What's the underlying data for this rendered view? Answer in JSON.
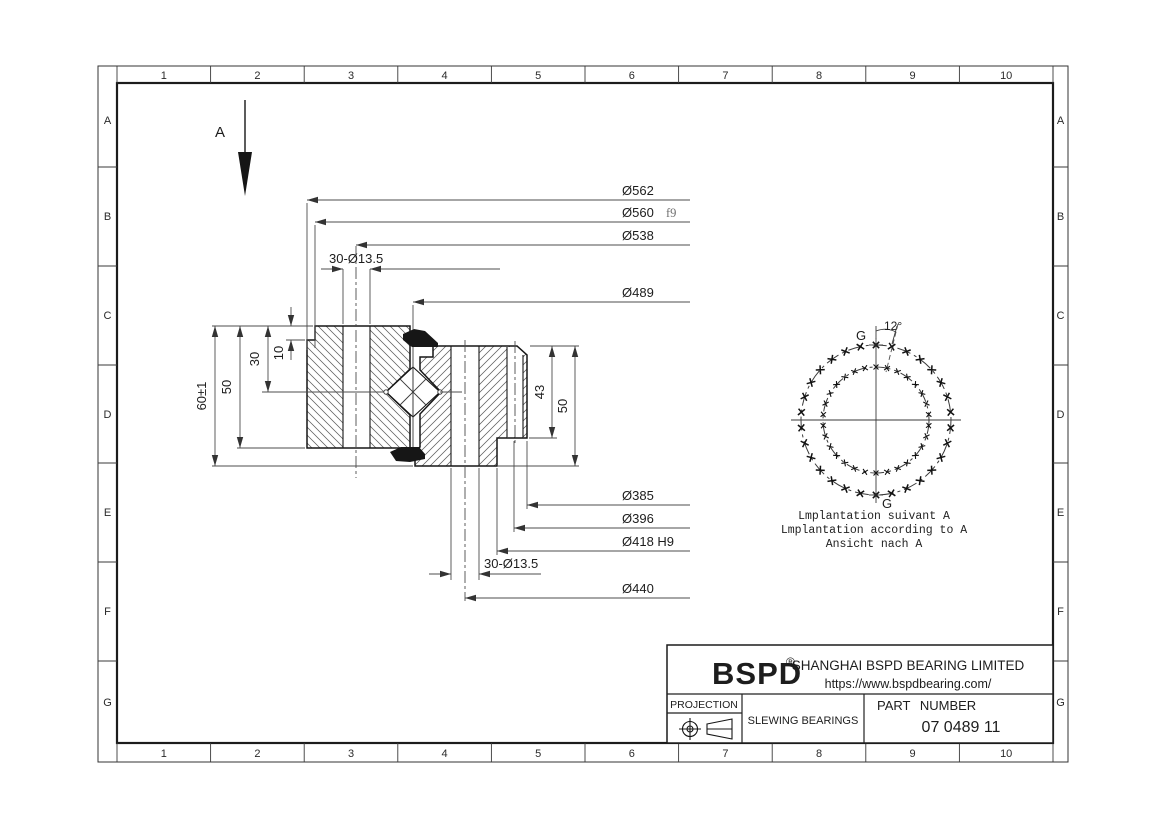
{
  "drawing": {
    "view_label": "A",
    "grid": {
      "columns": [
        "1",
        "2",
        "3",
        "4",
        "5",
        "6",
        "7",
        "8",
        "9",
        "10"
      ],
      "rows": [
        "A",
        "B",
        "C",
        "D",
        "E",
        "F",
        "G"
      ]
    },
    "dimensions": {
      "od_flange": "Ø562",
      "od_spigot": "Ø560",
      "od_spigot_fit": "f9",
      "outer_bolt_circle": "Ø538",
      "raceway": "Ø489",
      "outer_bolt_holes": "30-Ø13.5",
      "bore": "Ø385",
      "bore_step": "Ø396",
      "bore_recess": "Ø418 H9",
      "inner_bolt_circle": "Ø440",
      "inner_bolt_holes": "30-Ø13.5",
      "height_total": "60±1",
      "height_outer_ring": "50",
      "raceway_depth": "30",
      "spigot_height": "10",
      "inner_step_depth": "43",
      "height_inner_ring": "50"
    },
    "bolt_view": {
      "angle": "12°",
      "g_mark_top": "G",
      "g_mark_bottom": "G",
      "outer_marks": 30,
      "inner_marks": 30,
      "captions": [
        "Lmplantation suivant A",
        "Lmplantation according to A",
        "Ansicht nach A"
      ]
    },
    "title_block": {
      "brand": "BSPD",
      "registered": "®",
      "company": "SHANGHAI BSPD BEARING LIMITED",
      "website": "https://www.bspdbearing.com/",
      "projection_label": "PROJECTION",
      "product_type": "SLEWING BEARINGS",
      "part_number_label": "PART NUMBER",
      "part_number": "07 0489 11"
    }
  }
}
